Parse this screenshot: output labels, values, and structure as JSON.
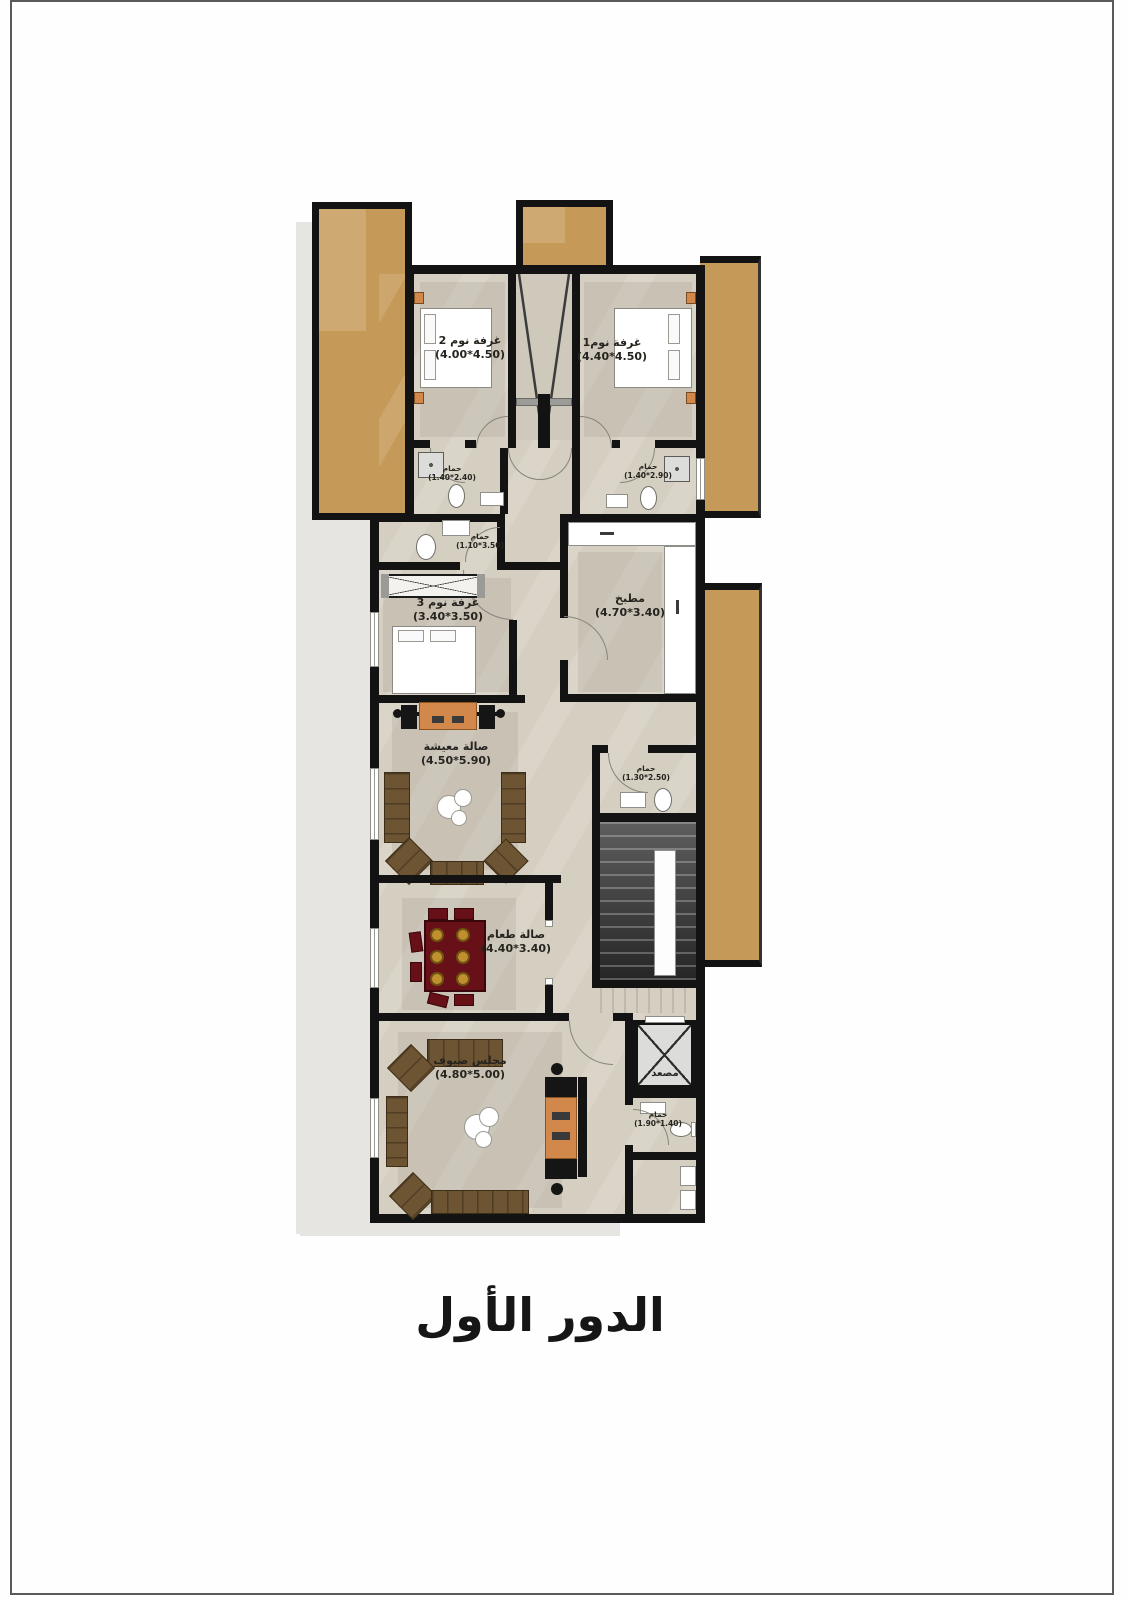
{
  "title": "الدور الأول",
  "colors": {
    "wall": "#131313",
    "floor": "#d5cfc1",
    "balcony": "#c59a58",
    "shadow": "#e7e5e2",
    "sofa": "#6d5433",
    "accent_orange": "#d2884a",
    "dining_table": "#671018",
    "plate_gold": "#c09030",
    "stairs_dark": "#3f3f3f"
  },
  "rooms": {
    "bedroom2": {
      "name": "غرفة نوم 2",
      "dims": "(4.50*4.00)"
    },
    "bedroom1": {
      "name": "غرفة نوم1",
      "dims": "(4.50*4.40)"
    },
    "bath_left": {
      "name": "حمام",
      "dims": "(2.40*1.40)"
    },
    "bath_right": {
      "name": "حمام",
      "dims": "(2.90*1.40)"
    },
    "bath_small": {
      "name": "حمام",
      "dims": "(3.50*1.10)"
    },
    "bedroom3": {
      "name": "غرفة نوم 3",
      "dims": "(3.50*3.40)"
    },
    "kitchen": {
      "name": "مطبخ",
      "dims": "(3.40*4.70)"
    },
    "living": {
      "name": "صالة معيشة",
      "dims": "(5.90*4.50)"
    },
    "wc_mid": {
      "name": "حمام",
      "dims": "(2.50*1.30)"
    },
    "dining": {
      "name": "صالة طعام",
      "dims": "(3.40*4.40)"
    },
    "majlis": {
      "name": "مجلس ضيوف",
      "dims": "(5.00*4.80)"
    },
    "elevator": {
      "name": "مصعد"
    },
    "bath_bottom": {
      "name": "حمام",
      "dims": "(1.40*1.90)"
    }
  }
}
